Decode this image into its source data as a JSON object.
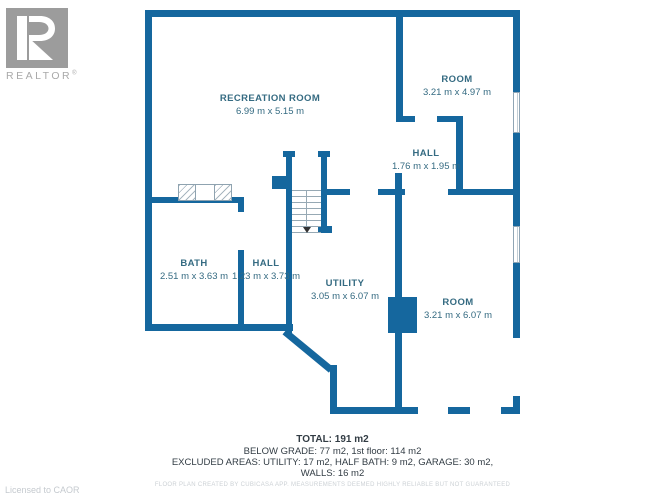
{
  "branding": {
    "logo_letter": "R",
    "logo_text": "REALTOR",
    "registered_mark": "®",
    "license_text": "Licensed to CAOR"
  },
  "rooms": [
    {
      "name": "RECREATION ROOM",
      "dimensions": "6.99 m x 5.15 m"
    },
    {
      "name": "ROOM",
      "dimensions": "3.21 m x 4.97 m"
    },
    {
      "name": "HALL",
      "dimensions": "1.76 m x 1.95 m"
    },
    {
      "name": "BATH",
      "dimensions": "2.51 m x 3.63 m"
    },
    {
      "name": "HALL",
      "dimensions": "1.23 m x 3.73 m"
    },
    {
      "name": "UTILITY",
      "dimensions": "3.05 m x 6.07 m"
    },
    {
      "name": "ROOM",
      "dimensions": "3.21 m x 6.07 m"
    }
  ],
  "summary": {
    "total": "TOTAL: 191 m2",
    "below_grade": "BELOW GRADE: 77 m2, 1st floor: 114 m2",
    "excluded": "EXCLUDED AREAS: UTILITY: 17 m2, HALF BATH: 9 m2, GARAGE: 30 m2,",
    "walls": "WALLS: 16 m2",
    "disclaimer": "FLOOR PLAN CREATED BY CUBICASA APP. MEASUREMENTS DEEMED HIGHLY RELIABLE BUT NOT GUARANTEED"
  },
  "colors": {
    "wall": "#15679e",
    "room_label": "#356b82",
    "summary_text": "#323c44",
    "logo_gray": "#9c9c9c",
    "muted_gray": "#ccd1d5"
  }
}
